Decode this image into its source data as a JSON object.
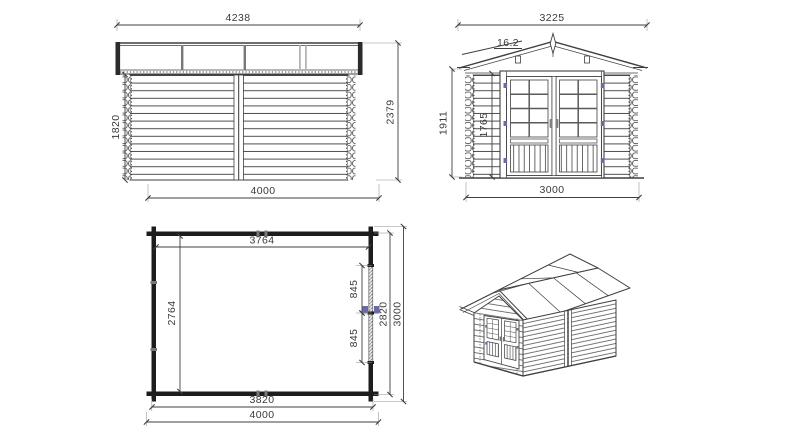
{
  "drawing": {
    "background": "#ffffff",
    "line_color": "#3f3f3f",
    "accent_color": "#6b6ba4",
    "side_elevation": {
      "roof_width": "4238",
      "wall_height": "1820",
      "total_height": "2379",
      "base_width": "4000"
    },
    "front_elevation": {
      "roof_width": "3225",
      "roof_angle": "16.2",
      "total_height": "1911",
      "wall_height": "1765",
      "base_width": "3000"
    },
    "floor_plan": {
      "inner_width": "3764",
      "inner_depth": "2764",
      "door_leaf_upper": "845",
      "door_leaf_lower": "845",
      "outer_depth_walls": "2820",
      "outer_depth": "3000",
      "inner_base_width": "3820",
      "base_width": "4000"
    }
  }
}
